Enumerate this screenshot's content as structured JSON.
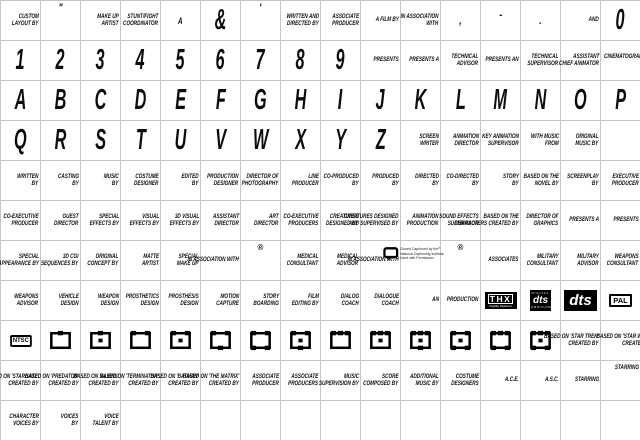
{
  "page": {
    "background": "#ffffff",
    "grid_line_color": "#c6c6c6",
    "text_color": "#0d0d0d",
    "cols": 16,
    "rows": 11
  },
  "logos": {
    "thx": {
      "title": "THX",
      "sub": "Digitally Mastered"
    },
    "dts_surround": {
      "top": "DIGITAL",
      "mid": "dts",
      "bottom": "SURROUND"
    },
    "dts": {
      "label": "dts"
    },
    "pal": {
      "label": "PAL"
    },
    "ntsc": {
      "label": "NTSC"
    },
    "cc": {
      "lines": [
        "Closed Captioned by the",
        "National Captioning Institute.",
        "Used with Permission."
      ],
      "reg": "®"
    },
    "registered_mark": "®"
  },
  "grid": {
    "rows": [
      [
        {
          "t": "tx",
          "l": [
            "CUSTOM",
            "LAYOUT BY"
          ]
        },
        {
          "t": "pu",
          "l": [
            "\""
          ],
          "p": "top2"
        },
        {
          "t": "tx",
          "l": [
            "MAKE UP",
            "ARTIST"
          ]
        },
        {
          "t": "tx",
          "l": [
            "STUNT/FIGHT",
            "COORDINATOR"
          ]
        },
        {
          "t": "gs",
          "l": [
            "A"
          ]
        },
        {
          "t": "g",
          "l": [
            "&"
          ]
        },
        {
          "t": "pu",
          "l": [
            "'"
          ],
          "p": "top2"
        },
        {
          "t": "tx",
          "l": [
            "WRITTEN AND",
            "DIRECTED BY"
          ]
        },
        {
          "t": "tx",
          "l": [
            "ASSOCIATE",
            "PRODUCER"
          ]
        },
        {
          "t": "tx",
          "l": [
            "A FILM BY"
          ]
        },
        {
          "t": "tx",
          "l": [
            "IN ASSOCIATION",
            "WITH"
          ]
        },
        {
          "t": "pu",
          "l": [
            ","
          ]
        },
        {
          "t": "pu",
          "l": [
            "-"
          ],
          "p": "hi"
        },
        {
          "t": "pu",
          "l": [
            "."
          ]
        },
        {
          "t": "tx",
          "l": [
            "AND"
          ]
        },
        {
          "t": "g",
          "l": [
            "0"
          ]
        }
      ],
      [
        {
          "t": "g",
          "l": [
            "1"
          ]
        },
        {
          "t": "g",
          "l": [
            "2"
          ]
        },
        {
          "t": "g",
          "l": [
            "3"
          ]
        },
        {
          "t": "g",
          "l": [
            "4"
          ]
        },
        {
          "t": "g",
          "l": [
            "5"
          ]
        },
        {
          "t": "g",
          "l": [
            "6"
          ]
        },
        {
          "t": "g",
          "l": [
            "7"
          ]
        },
        {
          "t": "g",
          "l": [
            "8"
          ]
        },
        {
          "t": "g",
          "l": [
            "9"
          ]
        },
        {
          "t": "tx",
          "l": [
            "PRESENTS"
          ]
        },
        {
          "t": "tx",
          "l": [
            "PRESENTS A"
          ]
        },
        {
          "t": "tx",
          "l": [
            "TECHNICAL",
            "ADVISOR"
          ]
        },
        {
          "t": "tx",
          "l": [
            "PRESENTS AN"
          ]
        },
        {
          "t": "tx",
          "l": [
            "TECHNICAL",
            "SUPERVISOR"
          ]
        },
        {
          "t": "tx",
          "l": [
            "ASSISTANT",
            "CHIEF ANIMATOR"
          ]
        },
        {
          "t": "tx",
          "l": [
            "CINEMATOGRAPHY",
            "BY"
          ],
          "dx": -10
        }
      ],
      [
        {
          "t": "g",
          "l": [
            "A"
          ]
        },
        {
          "t": "g",
          "l": [
            "B"
          ]
        },
        {
          "t": "g",
          "l": [
            "C"
          ]
        },
        {
          "t": "g",
          "l": [
            "D"
          ]
        },
        {
          "t": "g",
          "l": [
            "E"
          ]
        },
        {
          "t": "g",
          "l": [
            "F"
          ]
        },
        {
          "t": "g",
          "l": [
            "G"
          ]
        },
        {
          "t": "g",
          "l": [
            "H"
          ]
        },
        {
          "t": "g",
          "l": [
            "I"
          ]
        },
        {
          "t": "g",
          "l": [
            "J"
          ]
        },
        {
          "t": "g",
          "l": [
            "K"
          ]
        },
        {
          "t": "g",
          "l": [
            "L"
          ]
        },
        {
          "t": "g",
          "l": [
            "M"
          ]
        },
        {
          "t": "g",
          "l": [
            "N"
          ]
        },
        {
          "t": "g",
          "l": [
            "O"
          ]
        },
        {
          "t": "g",
          "l": [
            "P"
          ]
        }
      ],
      [
        {
          "t": "g",
          "l": [
            "Q"
          ]
        },
        {
          "t": "g",
          "l": [
            "R"
          ]
        },
        {
          "t": "g",
          "l": [
            "S"
          ]
        },
        {
          "t": "g",
          "l": [
            "T"
          ]
        },
        {
          "t": "g",
          "l": [
            "U"
          ]
        },
        {
          "t": "g",
          "l": [
            "V"
          ]
        },
        {
          "t": "g",
          "l": [
            "W"
          ]
        },
        {
          "t": "g",
          "l": [
            "X"
          ]
        },
        {
          "t": "g",
          "l": [
            "Y"
          ]
        },
        {
          "t": "g",
          "l": [
            "Z"
          ]
        },
        {
          "t": "tx",
          "l": [
            "SCREEN",
            "WRITER"
          ]
        },
        {
          "t": "tx",
          "l": [
            "ANIMATION",
            "DIRECTOR"
          ]
        },
        {
          "t": "tx",
          "l": [
            "KEY ANIMATION",
            "SUPERVISOR"
          ]
        },
        {
          "t": "tx",
          "l": [
            "WITH MUSIC",
            "FROM"
          ]
        },
        {
          "t": "tx",
          "l": [
            "ORIGINAL",
            "MUSIC BY"
          ]
        },
        {
          "t": "e"
        }
      ],
      [
        {
          "t": "tx",
          "l": [
            "WRITTEN",
            "BY"
          ]
        },
        {
          "t": "tx",
          "l": [
            "CASTING",
            "BY"
          ]
        },
        {
          "t": "tx",
          "l": [
            "MUSIC",
            "BY"
          ]
        },
        {
          "t": "tx",
          "l": [
            "COSTUME",
            "DESIGNER"
          ]
        },
        {
          "t": "tx",
          "l": [
            "EDITED",
            "BY"
          ]
        },
        {
          "t": "tx",
          "l": [
            "PRODUCTION",
            "DESIGNER"
          ]
        },
        {
          "t": "tx",
          "l": [
            "DIRECTOR OF",
            "PHOTOGRAPHY"
          ]
        },
        {
          "t": "tx",
          "l": [
            "LINE",
            "PRODUCER"
          ]
        },
        {
          "t": "tx",
          "l": [
            "CO-PRODUCED",
            "BY"
          ]
        },
        {
          "t": "tx",
          "l": [
            "PRODUCED",
            "BY"
          ]
        },
        {
          "t": "tx",
          "l": [
            "DIRECTED",
            "BY"
          ]
        },
        {
          "t": "tx",
          "l": [
            "CO-DIRECTED",
            "BY"
          ]
        },
        {
          "t": "tx",
          "l": [
            "STORY",
            "BY"
          ]
        },
        {
          "t": "tx",
          "l": [
            "BASED ON THE",
            "NOVEL BY"
          ]
        },
        {
          "t": "tx",
          "l": [
            "SCREENPLAY",
            "BY"
          ]
        },
        {
          "t": "tx",
          "l": [
            "EXECUTIVE",
            "PRODUCER"
          ]
        }
      ],
      [
        {
          "t": "tx",
          "l": [
            "CO-EXECUTIVE",
            "PRODUCER"
          ]
        },
        {
          "t": "tx",
          "l": [
            "GUEST",
            "DIRECTOR"
          ]
        },
        {
          "t": "tx",
          "l": [
            "SPECIAL",
            "EFFECTS BY"
          ]
        },
        {
          "t": "tx",
          "l": [
            "VISUAL",
            "EFFECTS BY"
          ]
        },
        {
          "t": "tx",
          "l": [
            "3D VISUAL",
            "EFFECTS BY"
          ]
        },
        {
          "t": "tx",
          "l": [
            "ASSISTANT",
            "DIRECTOR"
          ]
        },
        {
          "t": "tx",
          "l": [
            "ART",
            "DIRECTOR"
          ]
        },
        {
          "t": "tx",
          "l": [
            "CO-EXECUTIVE",
            "PRODUCERS"
          ]
        },
        {
          "t": "tx",
          "l": [
            "CREATURES",
            "DESIGNED BY"
          ]
        },
        {
          "t": "tx",
          "l": [
            "CREATURES DESIGNED",
            "AND SUPERVISED BY"
          ]
        },
        {
          "t": "tx",
          "l": [
            "ANIMATION",
            "PRODUCTION"
          ]
        },
        {
          "t": "tx",
          "l": [
            "SOUND EFFECTS",
            "SUPERVISOR"
          ]
        },
        {
          "t": "tx",
          "l": [
            "BASED ON THE",
            "CHARACTERS CREATED BY"
          ]
        },
        {
          "t": "tx",
          "l": [
            "DIRECTOR OF",
            "GRAPHICS"
          ]
        },
        {
          "t": "tx",
          "l": [
            "PRESENTS A"
          ]
        },
        {
          "t": "tx",
          "l": [
            "PRESENTS"
          ]
        }
      ],
      [
        {
          "t": "tx",
          "l": [
            "SPECIAL",
            "APPEARANCE BY"
          ]
        },
        {
          "t": "tx",
          "l": [
            "3D CGI",
            "SEQUENCES BY"
          ]
        },
        {
          "t": "tx",
          "l": [
            "ORIGINAL",
            "CONCEPT BY"
          ]
        },
        {
          "t": "tx",
          "l": [
            "MATTE",
            "ARTIST"
          ]
        },
        {
          "t": "tx",
          "l": [
            "SPECIAL",
            "MAKE UP"
          ]
        },
        {
          "t": "tx",
          "l": [
            "IN ASSOCIATION WITH"
          ]
        },
        {
          "t": "rg"
        },
        {
          "t": "tx",
          "l": [
            "MEDICAL",
            "CONSULTANT"
          ]
        },
        {
          "t": "tx",
          "l": [
            "MEDICAL",
            "ADVISOR"
          ]
        },
        {
          "t": "tx",
          "l": [
            "IN ASSOCIATION WITH"
          ]
        },
        {
          "t": "cc"
        },
        {
          "t": "rg"
        },
        {
          "t": "tx",
          "l": [
            "ASSOCIATES"
          ]
        },
        {
          "t": "tx",
          "l": [
            "MILITARY",
            "CONSULTANT"
          ]
        },
        {
          "t": "tx",
          "l": [
            "MILITARY",
            "ADVISOR"
          ]
        },
        {
          "t": "tx",
          "l": [
            "WEAPONS",
            "CONSULTANT"
          ]
        }
      ],
      [
        {
          "t": "tx",
          "l": [
            "WEAPONS",
            "ADVISOR"
          ]
        },
        {
          "t": "tx",
          "l": [
            "VEHICLE",
            "DESIGN"
          ]
        },
        {
          "t": "tx",
          "l": [
            "WEAPON",
            "DESIGN"
          ]
        },
        {
          "t": "tx",
          "l": [
            "PROSTHETICS",
            "DESIGN"
          ]
        },
        {
          "t": "tx",
          "l": [
            "PROSTHESIS",
            "DESIGN"
          ]
        },
        {
          "t": "tx",
          "l": [
            "MOTION",
            "CAPTURE"
          ]
        },
        {
          "t": "tx",
          "l": [
            "STORY",
            "BOARDING"
          ]
        },
        {
          "t": "tx",
          "l": [
            "FILM",
            "EDITING BY"
          ]
        },
        {
          "t": "tx",
          "l": [
            "DIALOG",
            "COACH"
          ]
        },
        {
          "t": "tx",
          "l": [
            "DIALOGUE",
            "COACH"
          ]
        },
        {
          "t": "tx",
          "l": [
            "AN"
          ]
        },
        {
          "t": "tx",
          "l": [
            "PRODUCTION"
          ]
        },
        {
          "t": "thx"
        },
        {
          "t": "dtsS"
        },
        {
          "t": "dts"
        },
        {
          "t": "pal"
        }
      ],
      [
        {
          "t": "ntsc"
        },
        {
          "t": "fr",
          "tt": 1,
          "bt": 0,
          "d": false
        },
        {
          "t": "fr",
          "tt": 1,
          "bt": 0,
          "d": true
        },
        {
          "t": "fr",
          "tt": 2,
          "bt": 0,
          "d": false
        },
        {
          "t": "fr",
          "tt": 2,
          "bt": 0,
          "d": true
        },
        {
          "t": "fr",
          "tt": 2,
          "bt": 1,
          "d": false
        },
        {
          "t": "fr",
          "tt": 2,
          "bt": 2,
          "d": false
        },
        {
          "t": "fr",
          "tt": 2,
          "bt": 1,
          "d": true
        },
        {
          "t": "fr",
          "tt": 3,
          "bt": 0,
          "d": false
        },
        {
          "t": "fr",
          "tt": 3,
          "bt": 0,
          "d": true
        },
        {
          "t": "fr",
          "tt": 3,
          "bt": 1,
          "d": true
        },
        {
          "t": "fr",
          "tt": 2,
          "bt": 2,
          "d": true
        },
        {
          "t": "fr",
          "tt": 3,
          "bt": 2,
          "d": false
        },
        {
          "t": "fr",
          "tt": 3,
          "bt": 2,
          "d": true
        },
        {
          "t": "tx",
          "l": [
            "BASED ON 'STAR TREK'",
            "CREATED BY"
          ]
        },
        {
          "t": "tx",
          "l": [
            "BASED ON 'STAR WARS'",
            "CREATED BY"
          ],
          "dx": -14
        }
      ],
      [
        {
          "t": "tx",
          "l": [
            "BASED ON 'STARGATE'",
            "CREATED BY"
          ]
        },
        {
          "t": "tx",
          "l": [
            "BASED ON 'PREDATOR'",
            "CREATED BY"
          ]
        },
        {
          "t": "tx",
          "l": [
            "BASED ON 'ALIENS'",
            "CREATED BY"
          ]
        },
        {
          "t": "tx",
          "l": [
            "BASED ON 'TERMINATOR'",
            "CREATED BY"
          ]
        },
        {
          "t": "tx",
          "l": [
            "BASED ON 'BATMAN'",
            "CREATED BY"
          ]
        },
        {
          "t": "tx",
          "l": [
            "BASED ON 'THE MATRIX'",
            "CREATED BY"
          ]
        },
        {
          "t": "tx",
          "l": [
            "ASSOCIATE",
            "PRODUCER"
          ]
        },
        {
          "t": "tx",
          "l": [
            "ASSOCIATE",
            "PRODUCERS"
          ]
        },
        {
          "t": "tx",
          "l": [
            "MUSIC",
            "SUPERVISION BY"
          ]
        },
        {
          "t": "tx",
          "l": [
            "SCORE",
            "COMPOSED BY"
          ]
        },
        {
          "t": "tx",
          "l": [
            "ADDITIONAL",
            "MUSIC BY"
          ]
        },
        {
          "t": "tx",
          "l": [
            "COSTUME",
            "DESIGNERS"
          ]
        },
        {
          "t": "tx",
          "l": [
            "A.C.E."
          ]
        },
        {
          "t": "tx",
          "l": [
            "A.S.C."
          ]
        },
        {
          "t": "tx",
          "l": [
            "STARRING"
          ]
        },
        {
          "t": "tx",
          "l": [
            "STARRING"
          ],
          "p": "top"
        }
      ],
      [
        {
          "t": "tx",
          "l": [
            "CHARACTER",
            "VOICES BY"
          ]
        },
        {
          "t": "tx",
          "l": [
            "VOICES",
            "BY"
          ]
        },
        {
          "t": "tx",
          "l": [
            "VOICE",
            "TALENT BY"
          ]
        },
        {
          "t": "e"
        },
        {
          "t": "e"
        },
        {
          "t": "e"
        },
        {
          "t": "e"
        },
        {
          "t": "e"
        },
        {
          "t": "e"
        },
        {
          "t": "e"
        },
        {
          "t": "e"
        },
        {
          "t": "e"
        },
        {
          "t": "e"
        },
        {
          "t": "e"
        },
        {
          "t": "e"
        },
        {
          "t": "e"
        }
      ]
    ]
  }
}
